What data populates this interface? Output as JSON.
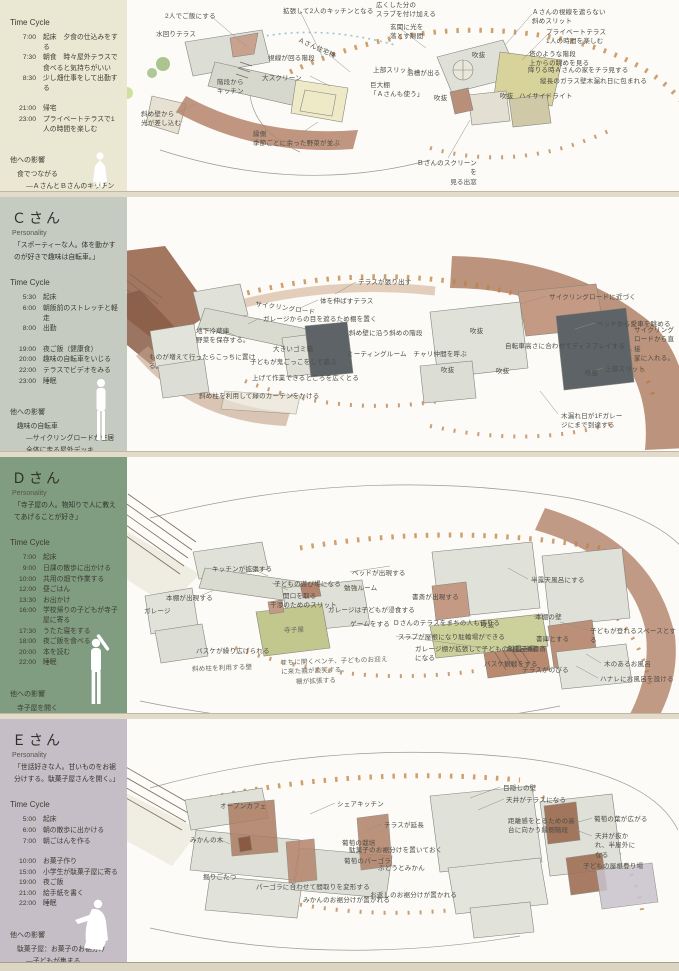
{
  "colors": {
    "sidebar_b": "#eae8d3",
    "sidebar_c": "#c6cbc2",
    "sidebar_d": "#819d81",
    "sidebar_e": "#c6bec6",
    "tick_orange": "#c08040",
    "terracotta": "#b08066",
    "dark_room": "#5e6367",
    "tatami": "#eeeac8",
    "teraco_dark": "#9c6a50",
    "olive": "#ccd09b",
    "teahouse_green": "#c2c78e"
  },
  "sections": [
    {
      "sidebar": {
        "name": "",
        "personality_label": "",
        "personality_text": "",
        "time_cycle_label": "Time Cycle",
        "schedule": [
          {
            "time": "7:00",
            "activity": "起床　夕食の仕込みをする"
          },
          {
            "time": "7:30",
            "activity": "朝食　時々屋外テラスで食べると気持ちがいい"
          },
          {
            "time": "8:30",
            "activity": "少し畑仕事をして出勤する"
          },
          {
            "time": "",
            "activity": ""
          },
          {
            "time": "21:00",
            "activity": "帰宅"
          },
          {
            "time": "23:00",
            "activity": "プライベートテラスで1人の時間を楽しむ"
          }
        ],
        "influence_title": "他への影響",
        "influence": [
          {
            "text": "食でつながる",
            "indent": 0
          },
          {
            "text": "―ＡさんとＢさんのキッチンがくっつく",
            "indent": 1
          },
          {
            "text": "日差しの光で",
            "indent": 0
          },
          {
            "text": "―野菜の洗い場とＡさんの洗濯場が吹抜けでつながる。日の光で包み込まれる。",
            "indent": 1
          }
        ]
      },
      "annotations": [
        {
          "text": "2人でご飯にする",
          "x": 165,
          "y": 12
        },
        {
          "text": "拡張して2人のキッチンとなる",
          "x": 283,
          "y": 7
        },
        {
          "text": "水回りテラス",
          "x": 156,
          "y": 30
        },
        {
          "text": "Ａさん住宅棟",
          "x": 300,
          "y": 36,
          "rot": 24
        },
        {
          "text": "視線が回る階段",
          "x": 268,
          "y": 54
        },
        {
          "text": "大スクリーン",
          "x": 262,
          "y": 74
        },
        {
          "text": "階段から\nキッチン",
          "x": 217,
          "y": 78
        },
        {
          "text": "斜め壁から\n光が差し込む",
          "x": 141,
          "y": 110
        },
        {
          "text": "縁側\n季節ごとに余った野菜が並ぶ",
          "x": 253,
          "y": 130
        },
        {
          "text": "広くした分の\nスラブを付け加える",
          "x": 376,
          "y": 1
        },
        {
          "text": "玄関に光を\n落とす隙間",
          "x": 390,
          "y": 23
        },
        {
          "text": "上部スリット",
          "x": 373,
          "y": 66
        },
        {
          "text": "浴槽が出る",
          "x": 407,
          "y": 69
        },
        {
          "text": "巨大棚\n「Ａさんも使う」",
          "x": 370,
          "y": 81
        },
        {
          "text": "Ａさんの視線を遮らない\n斜めスリット",
          "x": 532,
          "y": 8
        },
        {
          "text": "プライベートテラス\n1人の時間を楽しむ",
          "x": 546,
          "y": 28
        },
        {
          "text": "吹抜",
          "x": 472,
          "y": 51
        },
        {
          "text": "塔のような階段\n上からの眺めを見る",
          "x": 529,
          "y": 50
        },
        {
          "text": "降りる時Ａさんの家をチラ見する",
          "x": 528,
          "y": 66
        },
        {
          "text": "縦長のガラス壁木漏れ日に包まれる",
          "x": 540,
          "y": 77
        },
        {
          "text": "ハイサイドライト",
          "x": 519,
          "y": 92
        },
        {
          "text": "吹抜",
          "x": 434,
          "y": 94
        },
        {
          "text": "吹抜",
          "x": 500,
          "y": 92
        },
        {
          "text": "Ｂさんのスクリーンを\n見る出窓",
          "x": 413,
          "y": 159,
          "w": 64,
          "align": "right"
        }
      ]
    },
    {
      "sidebar": {
        "name": "Ｃさん",
        "personality_label": "Personality",
        "personality_text": "「スポーティーな人。体を動かすのが好きで趣味は自転車。」",
        "time_cycle_label": "Time Cycle",
        "schedule": [
          {
            "time": "5:30",
            "activity": "起床"
          },
          {
            "time": "6:00",
            "activity": "朝飯前のストレッチと軽走"
          },
          {
            "time": "8:00",
            "activity": "出勤"
          },
          {
            "time": "",
            "activity": ""
          },
          {
            "time": "19:00",
            "activity": "夜ご飯（健康食）"
          },
          {
            "time": "20:00",
            "activity": "趣味の自転車をいじる"
          },
          {
            "time": "22:00",
            "activity": "テラスでビデオをみる"
          },
          {
            "time": "23:00",
            "activity": "睡眠"
          }
        ],
        "influence_title": "他への影響",
        "influence": [
          {
            "text": "趣味の自転車",
            "indent": 0
          },
          {
            "text": "―サイクリングロードが住居全体に走る屋外デッキ",
            "indent": 1
          },
          {
            "text": "―ヨガやラジオ体操の場所として利用される",
            "indent": 1
          }
        ]
      },
      "annotations": [
        {
          "text": "テラスが張り出す",
          "x": 358,
          "y": 82
        },
        {
          "text": "体を伸ばすテラス",
          "x": 320,
          "y": 101
        },
        {
          "text": "サイクリングロード",
          "x": 256,
          "y": 104,
          "rot": 8
        },
        {
          "text": "ガレージからの目を遮るため棚を置く",
          "x": 263,
          "y": 119
        },
        {
          "text": "斜め壁に沿う斜めの階段",
          "x": 349,
          "y": 133
        },
        {
          "text": "地下冷蔵庫\n野菜を保存する。",
          "x": 196,
          "y": 131
        },
        {
          "text": "大きいゴミ箱",
          "x": 273,
          "y": 149
        },
        {
          "text": "ミーティングルーム　チャリ仲間を呼ぶ",
          "x": 347,
          "y": 154
        },
        {
          "text": "ものが増えて行ったらこっちに置け\nる。",
          "x": 149,
          "y": 157
        },
        {
          "text": "子どもが鬼ごっこをして遊ぶ",
          "x": 250,
          "y": 162
        },
        {
          "text": "上げて作業できるところを広くとる",
          "x": 252,
          "y": 178
        },
        {
          "text": "斜め柱を利用して緑のカーテンをかける",
          "x": 199,
          "y": 196
        },
        {
          "text": "サイクリングロードに近づく",
          "x": 549,
          "y": 97
        },
        {
          "text": "ベッドから愛車を眺める",
          "x": 597,
          "y": 124
        },
        {
          "text": "サイクリング\nロードから直接\n家に入れる。",
          "x": 634,
          "y": 130
        },
        {
          "text": "自転車高さに合わせてディスプレイする",
          "x": 505,
          "y": 146
        },
        {
          "text": "上部スリット",
          "x": 605,
          "y": 169
        },
        {
          "text": "吹抜",
          "x": 470,
          "y": 131
        },
        {
          "text": "吹抜",
          "x": 441,
          "y": 170
        },
        {
          "text": "吹抜",
          "x": 496,
          "y": 171
        },
        {
          "text": "吹抜",
          "x": 585,
          "y": 173
        },
        {
          "text": "木漏れ日が1Fガレー\nジにまで到達する",
          "x": 561,
          "y": 216
        }
      ]
    },
    {
      "sidebar": {
        "name": "Ｄさん",
        "personality_label": "Personality",
        "personality_text": "「寺子屋の人。物知りで人に教えてあげることが好き」",
        "time_cycle_label": "Time Cycle",
        "schedule": [
          {
            "time": "7:00",
            "activity": "起床"
          },
          {
            "time": "9:00",
            "activity": "日課の散歩に出かける"
          },
          {
            "time": "10:00",
            "activity": "共用の畑で作業する"
          },
          {
            "time": "12:00",
            "activity": "昼ごはん"
          },
          {
            "time": "13:30",
            "activity": "お出かけ"
          },
          {
            "time": "16:00",
            "activity": "学校帰りの子どもが寺子屋に寄る"
          },
          {
            "time": "17:30",
            "activity": "うたた寝をする"
          },
          {
            "time": "18:00",
            "activity": "夜ご飯を食べる"
          },
          {
            "time": "20:00",
            "activity": "本を読む"
          },
          {
            "time": "22:00",
            "activity": "睡眠"
          }
        ],
        "influence_title": "他への影響",
        "influence": [
          {
            "text": "寺子屋を開く",
            "indent": 0
          },
          {
            "text": "―まちの子どもが住居内に入り込み、遊び回る",
            "indent": 1
          },
          {
            "text": "溢れ出る知恵",
            "indent": 0
          },
          {
            "text": "―他の人の住居に本棚が進出する",
            "indent": 1
          }
        ]
      },
      "annotations": [
        {
          "text": "キッチンが拡張する",
          "x": 212,
          "y": 109
        },
        {
          "text": "ベッドが出現する",
          "x": 352,
          "y": 113
        },
        {
          "text": "子どもの遊び場になる",
          "x": 274,
          "y": 124
        },
        {
          "text": "勉強ルーム",
          "x": 344,
          "y": 128
        },
        {
          "text": "開口を取る",
          "x": 283,
          "y": 136
        },
        {
          "text": "干渉のためのスリット",
          "x": 270,
          "y": 145
        },
        {
          "text": "本棚が出現する",
          "x": 166,
          "y": 138
        },
        {
          "text": "ガレージ",
          "x": 144,
          "y": 151
        },
        {
          "text": "寺子屋",
          "x": 284,
          "y": 170,
          "cls": "hand"
        },
        {
          "text": "ガレージは子どもが浸食する",
          "x": 328,
          "y": 150
        },
        {
          "text": "ゲームをする",
          "x": 350,
          "y": 164
        },
        {
          "text": "スラブが屋根になり駐輪場ができる",
          "x": 398,
          "y": 177
        },
        {
          "text": "ガレージ棚が拡張して子どもの靴置き場\nになる",
          "x": 415,
          "y": 189
        },
        {
          "text": "バスケが繰り広げられる",
          "x": 196,
          "y": 191
        },
        {
          "text": "斜め柱を利用する壁",
          "x": 192,
          "y": 208,
          "cls": "hand"
        },
        {
          "text": "棚が拡張する",
          "x": 296,
          "y": 221,
          "cls": "hand"
        },
        {
          "text": "まちに開くベンチ、子どものお迎え\nに来た親が談笑する。",
          "x": 281,
          "y": 201,
          "cls": "hand"
        },
        {
          "text": "半露天風呂にする",
          "x": 531,
          "y": 120
        },
        {
          "text": "本棚の壁",
          "x": 535,
          "y": 157
        },
        {
          "text": "書斎が出現する",
          "x": 412,
          "y": 137
        },
        {
          "text": "Ｄさんのテラスをまちの人も借りる",
          "x": 393,
          "y": 163
        },
        {
          "text": "吹抜",
          "x": 481,
          "y": 165
        },
        {
          "text": "子どもが登れるスペースとする",
          "x": 590,
          "y": 171
        },
        {
          "text": "書庫とする",
          "x": 536,
          "y": 179
        },
        {
          "text": "お風呂兼書斎",
          "x": 506,
          "y": 189
        },
        {
          "text": "バスケ観戦をする",
          "x": 484,
          "y": 204
        },
        {
          "text": "テラスがのびる",
          "x": 522,
          "y": 210
        },
        {
          "text": "木のあるお風呂",
          "x": 604,
          "y": 204
        },
        {
          "text": "ハナレにお風呂を設ける",
          "x": 600,
          "y": 219
        }
      ]
    },
    {
      "sidebar": {
        "name": "Ｅさん",
        "personality_label": "Personality",
        "personality_text": "「世話好きな人。甘いものをお裾分けする。駄菓子屋さんを開く。」",
        "time_cycle_label": "Time Cycle",
        "schedule": [
          {
            "time": "5:00",
            "activity": "起床"
          },
          {
            "time": "6:00",
            "activity": "朝の散歩に出かける"
          },
          {
            "time": "7:00",
            "activity": "朝ごはんを作る"
          },
          {
            "time": "",
            "activity": ""
          },
          {
            "time": "10:00",
            "activity": "お菓子作り"
          },
          {
            "time": "15:00",
            "activity": "小学生が駄菓子屋に寄る"
          },
          {
            "time": "19:00",
            "activity": "夜ご飯"
          },
          {
            "time": "21:00",
            "activity": "絵手紙を書く"
          },
          {
            "time": "22:00",
            "activity": "睡眠"
          }
        ],
        "influence_title": "他への影響",
        "influence": [
          {
            "text": "駄菓子屋：お菓子のお裾分け",
            "indent": 0
          },
          {
            "text": "―子どもが集まる",
            "indent": 1
          },
          {
            "text": "葡萄のパーゴラ",
            "indent": 0
          },
          {
            "text": "―木漏れ日空間の創出",
            "indent": 1
          }
        ]
      },
      "annotations": [
        {
          "text": "オープンカフェ",
          "x": 220,
          "y": 84
        },
        {
          "text": "シェアキッチン",
          "x": 337,
          "y": 82
        },
        {
          "text": "テラスが延長",
          "x": 384,
          "y": 103
        },
        {
          "text": "みかんの木",
          "x": 190,
          "y": 118
        },
        {
          "text": "葡萄の栽培",
          "x": 342,
          "y": 121
        },
        {
          "text": "駄菓子のお裾分けを置いておく",
          "x": 349,
          "y": 128
        },
        {
          "text": "葡萄のパーゴラ",
          "x": 344,
          "y": 139
        },
        {
          "text": "ぶどうとみかん",
          "x": 378,
          "y": 146
        },
        {
          "text": "掘りごたつ",
          "x": 203,
          "y": 155
        },
        {
          "text": "パーゴラに合わせて間取りを変形する",
          "x": 256,
          "y": 165
        },
        {
          "text": "みかんのお裾分けが置かれる",
          "x": 303,
          "y": 178
        },
        {
          "text": "お返しのお裾分けが置かれる",
          "x": 370,
          "y": 173
        },
        {
          "text": "目隠しの壁",
          "x": 503,
          "y": 66
        },
        {
          "text": "天井がテラスになる",
          "x": 506,
          "y": 78
        },
        {
          "text": "葡萄の葉が広がる",
          "x": 594,
          "y": 97
        },
        {
          "text": "距離感をとるための高\n台に向かう縁側階段",
          "x": 508,
          "y": 99
        },
        {
          "text": "天井が抜かれ、半屋外になる",
          "x": 595,
          "y": 114,
          "w": 44
        },
        {
          "text": "子どもの屋根登り場",
          "x": 583,
          "y": 144
        }
      ]
    }
  ]
}
